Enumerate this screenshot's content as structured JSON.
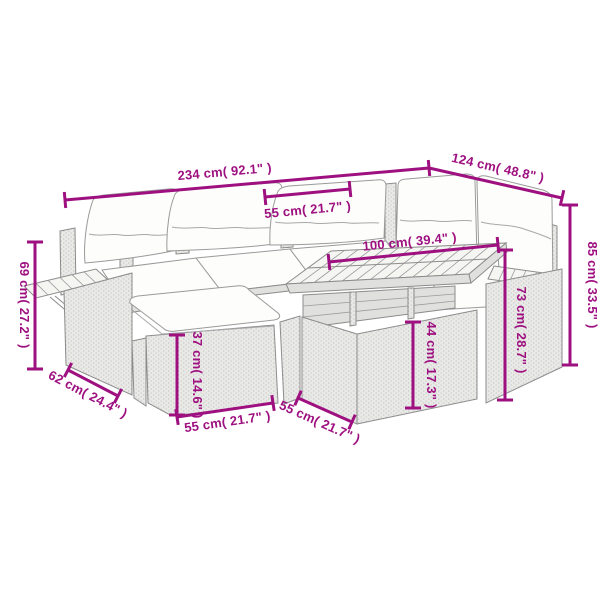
{
  "diagram": {
    "type": "product-dimension-diagram",
    "subject": "rattan corner garden sofa set with cushions, ottoman and slatted-top storage table",
    "background_color": "#ffffff",
    "accent_color": "#9E1080",
    "artwork_line_color": "#8c8c8c"
  },
  "dimensions": [
    {
      "id": "total-width",
      "value_cm": 234,
      "value_in": 92.1,
      "label": "234 cm( 92.1\" )"
    },
    {
      "id": "wing-depth",
      "value_cm": 124,
      "value_in": 48.8,
      "label": "124 cm( 48.8\" )"
    },
    {
      "id": "seat-width",
      "value_cm": 55,
      "value_in": 21.7,
      "label": "55 cm( 21.7\" )"
    },
    {
      "id": "table-top-width",
      "value_cm": 100,
      "value_in": 39.4,
      "label": "100 cm( 39.4\" )"
    },
    {
      "id": "total-height",
      "value_cm": 85,
      "value_in": 33.5,
      "label": "85 cm( 33.5\" )"
    },
    {
      "id": "arm-height",
      "value_cm": 73,
      "value_in": 28.7,
      "label": "73 cm( 28.7\" )"
    },
    {
      "id": "back-height",
      "value_cm": 69,
      "value_in": 27.2,
      "label": "69 cm( 27.2\" )"
    },
    {
      "id": "side-depth",
      "value_cm": 62,
      "value_in": 24.4,
      "label": "62 cm( 24.4\" )"
    },
    {
      "id": "ottoman-height",
      "value_cm": 37,
      "value_in": 14.6,
      "label": "37 cm( 14.6\" )"
    },
    {
      "id": "ottoman-width",
      "value_cm": 55,
      "value_in": 21.7,
      "label": "55 cm( 21.7\" )"
    },
    {
      "id": "table-depth",
      "value_cm": 55,
      "value_in": 21.7,
      "label": "55 cm( 21.7\" )"
    },
    {
      "id": "table-height",
      "value_cm": 44,
      "value_in": 17.3,
      "label": "44 cm( 17.3\" )"
    }
  ]
}
